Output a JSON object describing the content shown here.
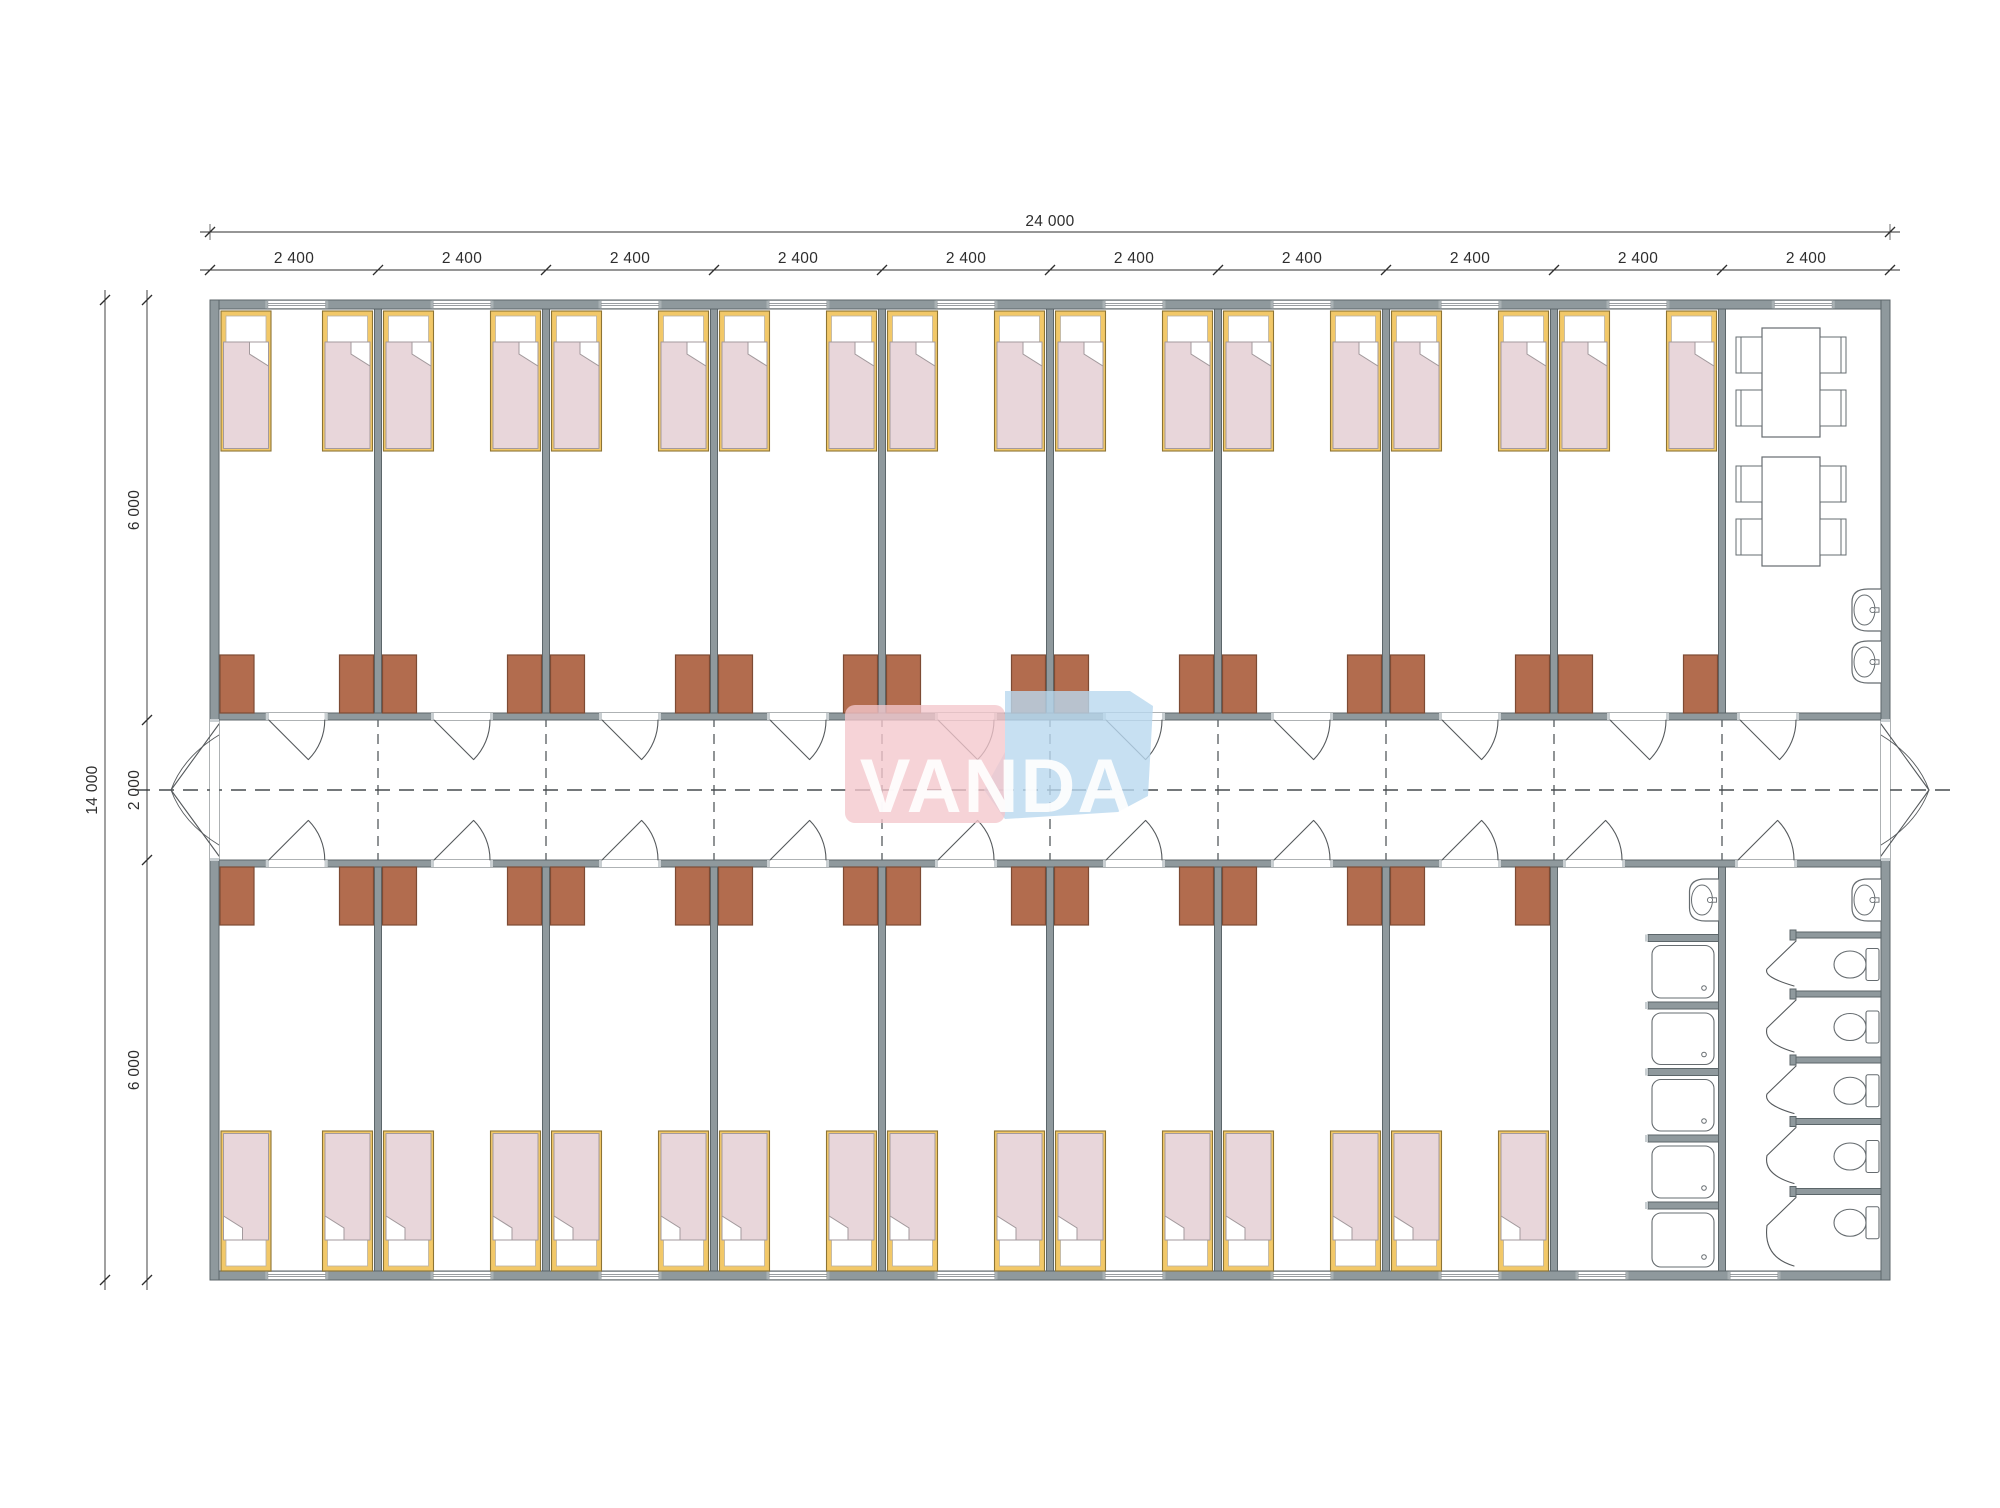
{
  "brand": {
    "name": "VANDA"
  },
  "dimensions": {
    "overall_width": "24 000",
    "overall_height": "14 000",
    "bays": [
      "2 400",
      "2 400",
      "2 400",
      "2 400",
      "2 400",
      "2 400",
      "2 400",
      "2 400",
      "2 400",
      "2 400"
    ],
    "vertical_segments": [
      "6 000",
      "2 000",
      "6 000"
    ]
  },
  "plan": {
    "building": {
      "width_mm": 24000,
      "height_mm": 14000,
      "bay_mm": 2400,
      "corridor_mm": 2000,
      "bay_count": 10
    },
    "rooms": {
      "top_bedrooms": 9,
      "bottom_bedrooms": 8,
      "dining": {
        "tables": 2,
        "chairs_per_table": 4,
        "wall_sinks": 2
      },
      "washroom": {
        "shower_trays": 5,
        "wall_sinks": 1
      },
      "wc": {
        "toilet_stalls": 5,
        "wall_sinks": 1
      }
    },
    "furniture_counts": {
      "beds": 34,
      "wardrobes": 34,
      "room_doors": 21,
      "corridor_exit_doors": 2,
      "windows": 19
    }
  },
  "colors": {
    "background": "#ffffff",
    "wall_fill": "#8f999d",
    "wall_stroke": "#5c666a",
    "wall_cap": "#c9cfd2",
    "bed_frame": "#f2c868",
    "bed_frame_stroke": "#8d7434",
    "bed_pillow": "#ffffff",
    "bed_blanket": "#e8d6da",
    "bed_blanket_stroke": "#a39a9d",
    "wardrobe_fill": "#b26c4e",
    "wardrobe_stroke": "#7d4b34",
    "fixture_stroke": "#666c70",
    "door_stroke": "#55595c",
    "centerline": "#474c4f",
    "dimension": "#2e2e2e",
    "logo_pink": "#f3c6cc",
    "logo_blue": "#b9d8ef",
    "logo_text": "#ffffff"
  }
}
